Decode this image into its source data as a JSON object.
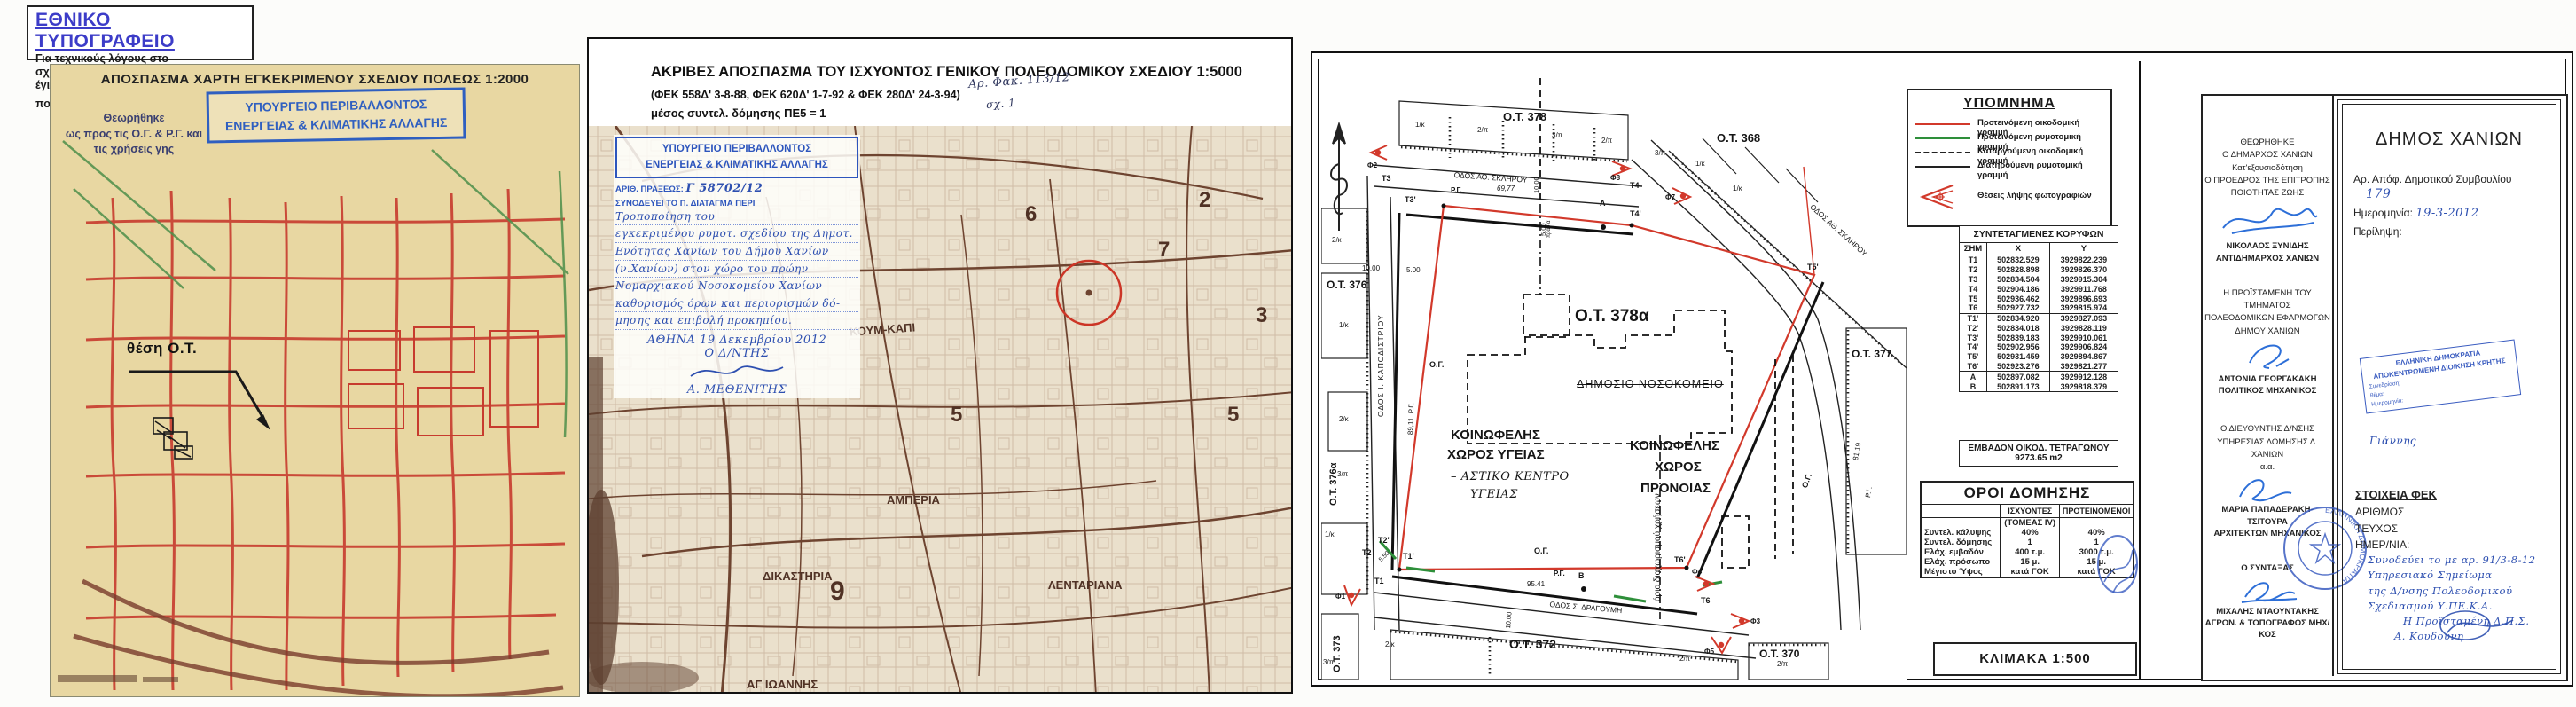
{
  "printer": {
    "title": "ΕΘΝΙΚΟ ΤΥΠΟΓΡΑΦΕΙΟ",
    "note1": "Για τεχνικούς λόγους στο σχεδιάγραμμα,",
    "note2": "έγινε σμίκρυνση, κατά ποσοστό",
    "percent": "40%"
  },
  "left": {
    "title": "ΑΠΟΣΠΑΣΜΑ ΧΑΡΤΗ ΕΓΚΕΚΡΙΜΕΝΟΥ ΣΧΕΔΙΟΥ ΠΟΛΕΩΣ 1:2000",
    "approved": [
      "Θεωρήθηκε",
      "ως προς τις Ο.Γ. & Ρ.Γ. και",
      "τις χρήσεις γης"
    ],
    "stamp": [
      "ΥΠΟΥΡΓΕΙΟ ΠΕΡΙΒΑΛΛΟΝΤΟΣ",
      "ΕΝΕΡΓΕΙΑΣ & ΚΛΙΜΑΤΙΚΗΣ ΑΛΛΑΓΗΣ"
    ],
    "location": "θέση Ο.Τ."
  },
  "middle": {
    "title1": "ΑΚΡΙΒΕΣ ΑΠΟΣΠΑΣΜΑ ΤΟΥ ΙΣΧΥΟΝΤΟΣ ΓΕΝΙΚΟΥ ΠΟΛΕΟΔΟΜΙΚΟΥ ΣΧΕΔΙΟΥ 1:5000",
    "title2": "(ΦΕΚ 558Δ' 3-8-88,  ΦΕΚ 620Δ' 1-7-92 & ΦΕΚ 280Δ' 24-3-94)",
    "title3": "μέσος συντελ. δόμησης ΠΕ5 = 1",
    "file_ref": "Αρ. Φακ. 113/12",
    "sheet_ref": "σχ. 1",
    "stamp": {
      "min1": "ΥΠΟΥΡΓΕΙΟ ΠΕΡΙΒΑΛΛΟΝΤΟΣ",
      "min2": "ΕΝΕΡΓΕΙΑΣ & ΚΛΙΜΑΤΙΚΗΣ ΑΛΛΑΓΗΣ",
      "praxis_label": "ΑΡΙΘ. ΠΡΑΞΕΩΣ:",
      "praxis_value": "Γ 58702/12",
      "decree_label": "ΣΥΝΟΔΕΥΕΙ ΤΟ Π. ΔΙΑΤΑΓΜΑ ΠΕΡΙ",
      "decree": [
        "Τροποποίηση του",
        "εγκεκριμένου ρυμοτ. σχεδίου της Δημοτ.",
        "Ενότητας Χανίων του Δήμου Χανίων",
        "(ν.Χανίων) στον χώρο του πρώην",
        "Νομαρχιακού Νοσοκομείου Χανίων",
        "καθορισμός όρων και περιορισμών δό-",
        "μησης και επιβολή προκηπίου."
      ],
      "date": "ΑΘΗΝΑ 19 Δεκεμβρίου 2012",
      "role": "Ο Δ/ΝΤΗΣ",
      "name": "Α. ΜΕΘΕΝΙΤΗΣ"
    },
    "map": {
      "koum": "ΚΟΥΜ-ΚΑΠΙ",
      "amperia": "ΑΜΠΕΡΙΑ",
      "dikastiria": "ΔΙΚΑΣΤΗΡΙΑ",
      "lentariana": "ΛΕΝΤΑΡΙΑΝΑ",
      "agioannis": "ΑΓ ΙΩΑΝΝΗΣ",
      "n9": "9",
      "n6": "6",
      "n7": "7",
      "n5a": "5",
      "n5b": "5",
      "n3": "3",
      "n2": "2"
    }
  },
  "right": {
    "legend": {
      "title": "ΥΠΟΜΝΗΜΑ",
      "items": [
        {
          "label": "Προτεινόμενη οικοδομική γραμμή"
        },
        {
          "label": "Προτεινόμενη ρυμοτομική γραμμή"
        },
        {
          "label": "Καταργούμενη οικοδομική γραμμή"
        },
        {
          "label": "Διατηρούμενη ρυμοτομική γραμμή"
        }
      ],
      "camera_label": "Θέσεις λήψης φωτογραφιών"
    },
    "coords": {
      "title": "ΣΥΝΤΕΤΑΓΜΕΝΕΣ ΚΟΡΥΦΩΝ",
      "h": [
        "ΣΗΜ",
        "Χ",
        "Υ"
      ],
      "groups": [
        [
          [
            "Τ1",
            "502832.529",
            "3929822.239"
          ],
          [
            "Τ2",
            "502828.898",
            "3929826.370"
          ],
          [
            "Τ3",
            "502834.504",
            "3929915.304"
          ],
          [
            "Τ4",
            "502904.186",
            "3929911.768"
          ],
          [
            "Τ5",
            "502936.462",
            "3929896.693"
          ],
          [
            "Τ6",
            "502927.732",
            "3929815.974"
          ]
        ],
        [
          [
            "Τ1'",
            "502834.920",
            "3929827.093"
          ],
          [
            "Τ2'",
            "502834.018",
            "3929828.119"
          ],
          [
            "Τ3'",
            "502839.183",
            "3929910.061"
          ],
          [
            "Τ4'",
            "502902.956",
            "3929906.824"
          ],
          [
            "Τ5'",
            "502931.459",
            "3929894.867"
          ],
          [
            "Τ6'",
            "502923.276",
            "3929821.277"
          ]
        ],
        [
          [
            "Α",
            "502897.082",
            "3929912.128"
          ],
          [
            "Β",
            "502891.173",
            "3929818.379"
          ]
        ]
      ]
    },
    "area": {
      "l1": "ΕΜΒΑΔΟΝ ΟΙΚΟΔ. ΤΕΤΡΑΓΩΝΟΥ",
      "l2": "9273.65 m2"
    },
    "terms": {
      "title": "ΟΡΟΙ ΔΟΜΗΣΗΣ",
      "c1": "ΙΣΧΥΟΝΤΕΣ",
      "c2": "ΠΡΟΤΕΙΝΟΜΕΝΟΙ",
      "rows": [
        [
          "",
          "(ΤΟΜΕΑΣ IV)",
          ""
        ],
        [
          "Συντελ. κάλυψης",
          "40%",
          "40%"
        ],
        [
          "Συντελ. δόμησης",
          "1",
          "1"
        ],
        [
          "Ελάχ. εμβαδόν",
          "400 τ.μ.",
          "3000 τ.μ."
        ],
        [
          "Ελάχ. πρόσωπο",
          "15 μ.",
          "15 μ."
        ],
        [
          "Μέγιστο Ύψος",
          "κατά ΓΟΚ",
          "κατά ΓΟΚ"
        ]
      ]
    },
    "scale": "ΚΛΙΜΑΚΑ 1:500",
    "map": {
      "ot378": "Ο.Τ. 378",
      "ot368": "Ο.Τ. 368",
      "ot376": "Ο.Τ. 376",
      "ot376a": "Ο.Τ. 376α",
      "ot373": "Ο.Τ. 373",
      "ot372": "Ο.Τ. 372",
      "ot370": "Ο.Τ. 370",
      "ot377": "Ο.Τ. 377",
      "ot378a": "Ο.Τ. 378α",
      "st_top": "ΟΔΟΣ ΑΘ. ΣΚΛΗΡΟΥ",
      "st_right": "ΟΔΟΣ ΑΘ. ΣΚΛΗΡΟΥ",
      "st_left": "ΟΔΟΣ Ι. ΚΑΠΟΔΙΣΤΡΙΟΥ",
      "st_bottom": "ΟΔΟΣ Σ. ΔΡΑΓΟΥΜΗ",
      "building": "ΔΗΜΟΣΙΟ ΝΟΣΟΚΟΜΕΙΟ",
      "zh1": "ΚΟΙΝΩΦΕΛΗΣ",
      "zh2": "ΧΩΡΟΣ ΥΓΕΙΑΣ",
      "zhn1": "– ΑΣΤΙΚΟ ΚΕΝΤΡΟ",
      "zhn2": "ΥΓΕΙΑΣ",
      "zw1": "ΚΟΙΝΩΦΕΛΗΣ",
      "zw2": "ΧΩΡΟΣ",
      "zw3": "ΠΡΟΝΟΙΑΣ",
      "orio": "όριο διαχωρισμού χρήσεων",
      "og": "Ο.Γ.",
      "rg": "Ρ.Γ.",
      "t1": "Τ1",
      "t2": "Τ2",
      "t3": "Τ3",
      "t4": "Τ4",
      "t6": "Τ6",
      "t1p": "Τ1'",
      "t2p": "Τ2'",
      "t3p": "Τ3'",
      "t4p": "Τ4'",
      "t5p": "Τ5'",
      "t6p": "Τ6'",
      "a": "Α",
      "b": "Β",
      "d_top": "69,77",
      "d_bottom": "95.41",
      "d_left": "89,11",
      "d_right": "81,19",
      "d_road": "10.00",
      "d_setback": "5.00",
      "d_prasia": "πρασιά",
      "d_550": "5.50",
      "f1": "Φ1",
      "f2": "Φ2",
      "f3": "Φ3",
      "f4": "Φ4",
      "f5": "Φ5",
      "f7": "Φ7",
      "f8": "Φ8",
      "p": [
        "1/κ",
        "2/π",
        "3/π",
        "2/π",
        "3/π",
        "1/κ",
        "1/κ",
        "2/κ",
        "1/κ",
        "2/κ",
        "3/π",
        "1/κ",
        "2/κ",
        "2/π",
        "2/π",
        "3/π"
      ]
    },
    "sig": {
      "b1": [
        "ΘΕΩΡΗΘΗΚΕ",
        "Ο ΔΗΜΑΡΧΟΣ ΧΑΝΙΩΝ",
        "Κατ'εξουσιοδότηση",
        "Ο ΠΡΟΕΔΡΟΣ ΤΗΣ ΕΠΙΤΡΟΠΗΣ",
        "ΠΟΙΟΤΗΤΑΣ ΖΩΗΣ"
      ],
      "n1": "ΝΙΚΟΛΑΟΣ ΞΥΝΙΔΗΣ",
      "r1": "ΑΝΤΙΔΗΜΑΡΧΟΣ ΧΑΝΙΩΝ",
      "b2": [
        "Η ΠΡΟΪΣΤΑΜΕΝΗ ΤΟΥ ΤΜΗΜΑΤΟΣ",
        "ΠΟΛΕΟΔΟΜΙΚΩΝ ΕΦΑΡΜΟΓΩΝ",
        "ΔΗΜΟΥ ΧΑΝΙΩΝ"
      ],
      "n2": "ΑΝΤΩΝΙΑ ΓΕΩΡΓΑΚΑΚΗ",
      "r2": "ΠΟΛΙΤΙΚΟΣ ΜΗΧΑΝΙΚΟΣ",
      "b3": [
        "Ο ΔΙΕΥΘΥΝΤΗΣ Δ/ΝΣΗΣ",
        "ΥΠΗΡΕΣΙΑΣ ΔΟΜΗΣΗΣ Δ. ΧΑΝΙΩΝ",
        "α.α."
      ],
      "n3": "ΜΑΡΙΑ ΠΑΠΑΔΕΡΑΚΗ-ΤΣΙΤΟΥΡΑ",
      "r3": "ΑΡΧΙΤΕΚΤΩΝ ΜΗΧΑΝΙΚΟΣ",
      "b4": "Ο ΣΥΝΤΑΞΑΣ",
      "n4": "ΜΙΧΑΛΗΣ ΝΤΑΟΥΝΤΑΚΗΣ",
      "r4": "ΑΓΡΟΝ. & ΤΟΠΟΓΡΑΦΟΣ ΜΗΧ/ΚΟΣ",
      "round_stamp": "ΕΛΛΗΝΙΚΗ ΔΗΜΟΚΡΑΤΙΑ"
    },
    "dimos": {
      "title": "ΔΗΜΟΣ ΧΑΝΙΩΝ",
      "ref_label": "Αρ. Απόφ. Δημοτικού Συμβουλίου",
      "ref_value": "179",
      "date_label": "Ημερομηνία:",
      "date_value": "19-3-2012",
      "summary_label": "Περίληψη:",
      "stamp": [
        "ΕΛΛΗΝΙΚΗ ΔΗΜΟΚΡΑΤΙΑ",
        "ΑΠΟΚΕΝΤΡΩΜΕΝΗ ΔΙΟΙΚΗΣΗ ΚΡΗΤΗΣ",
        "Συνεδρίαση:",
        "θέμα:",
        "Ημερομηνία:"
      ],
      "stamp_sig": "Γιάννης",
      "fek_title": "ΣΤΟΙΧΕΙΑ ΦΕΚ",
      "fek1": "ΑΡΙΘΜΟΣ",
      "fek2": "ΤΕΥΧΟΣ",
      "fek3": "ΗΜΕΡ/ΝΙΑ:",
      "note": [
        "Συνοδεύει το με αρ. 91/3-8-12",
        "Υπηρεσιακό Σημείωμα",
        "της Δ/νσης Πολεοδομικού",
        "Σχεδιασμού Υ.ΠΕ.Κ.Α.",
        "Η Προϊσταμένη Δ.Π.Σ.",
        "Α. Κουδούνη"
      ]
    }
  },
  "colors": {
    "stamp_blue": "#2d55bd",
    "map_red": "#d2392b",
    "map_green": "#2e8f3a",
    "tan": "#e8d7a2",
    "sepia": "#7b4c33"
  }
}
